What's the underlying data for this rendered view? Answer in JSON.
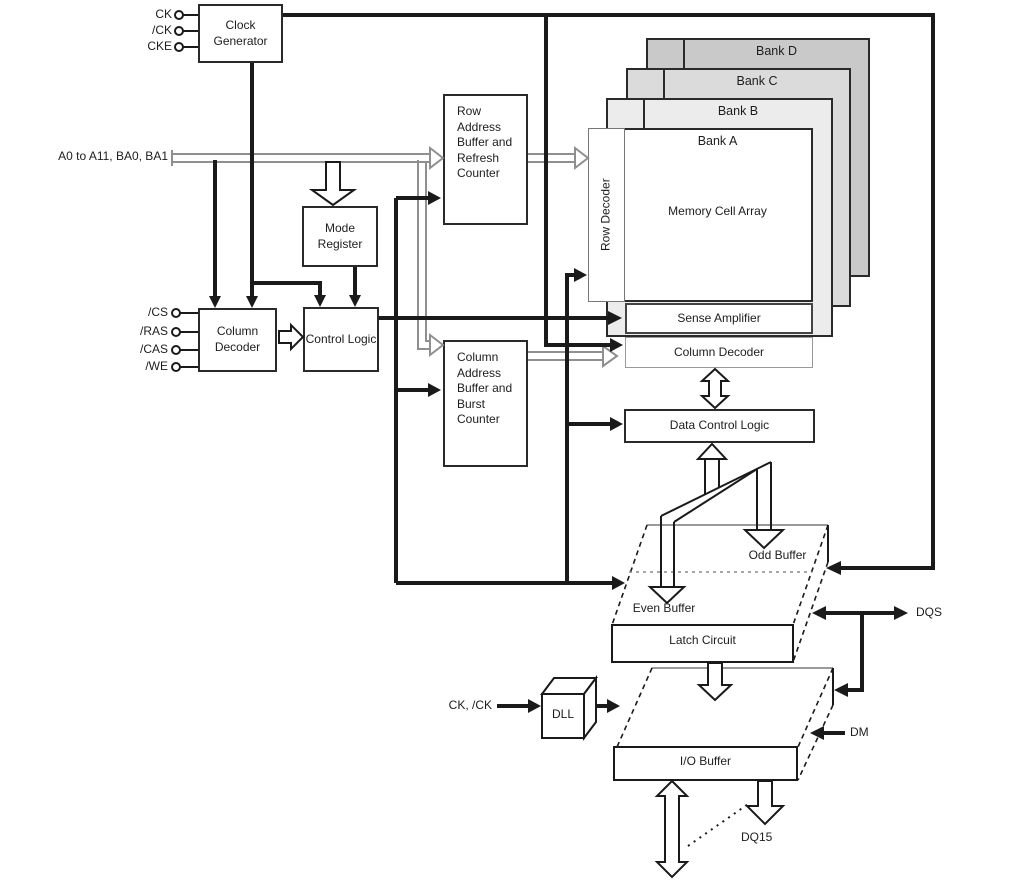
{
  "colors": {
    "line_black": "#1a1a1a",
    "line_gray": "#8f8f8f",
    "bank_d_fill": "#c9c9c9",
    "bank_c_fill": "#dbdbdb",
    "bank_b_fill": "#ececec",
    "box_fill": "#ffffff"
  },
  "inputs": {
    "ck": "CK",
    "ckb": "/CK",
    "cke": "CKE",
    "address_bus": "A0 to A11, BA0, BA1",
    "cs": "/CS",
    "ras": "/RAS",
    "cas": "/CAS",
    "we": "/WE",
    "ck_pair": "CK, /CK"
  },
  "outputs": {
    "dqs": "DQS",
    "dm": "DM",
    "dq15": "DQ15"
  },
  "blocks": {
    "clock_generator": "Clock Generator",
    "mode_register": "Mode Register",
    "column_decoder_input": "Column Decoder",
    "control_logic": "Control Logic",
    "row_address_buffer": "Row Address Buffer and Refresh Counter",
    "column_address_buffer": "Column Address Buffer and Burst Counter",
    "row_decoder": "Row Decoder",
    "memory_cell_array": "Memory Cell Array",
    "sense_amplifier": "Sense Amplifier",
    "column_decoder": "Column Decoder",
    "data_control_logic": "Data Control Logic",
    "odd_buffer": "Odd Buffer",
    "even_buffer": "Even Buffer",
    "latch_circuit": "Latch Circuit",
    "dll": "DLL",
    "io_buffer": "I/O Buffer"
  },
  "banks": {
    "a": "Bank A",
    "b": "Bank B",
    "c": "Bank C",
    "d": "Bank D"
  }
}
